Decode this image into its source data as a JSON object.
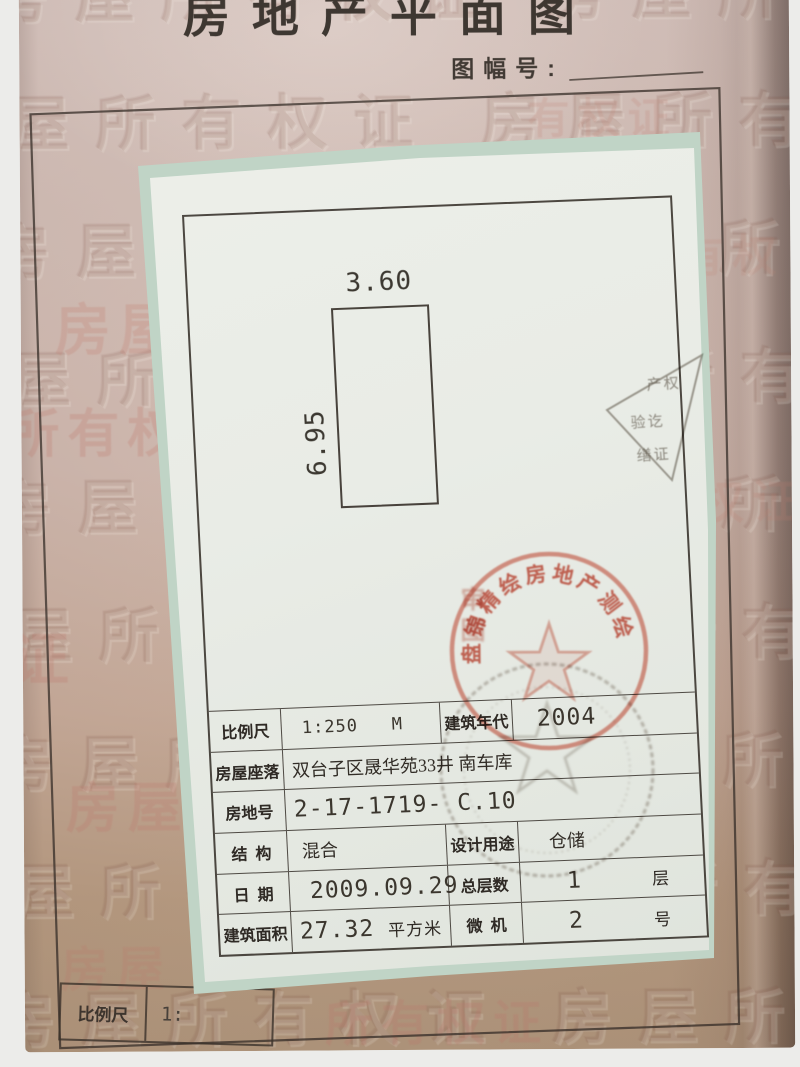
{
  "photo": {
    "title": "房地产平面图",
    "sheet_label": "图幅号:",
    "watermark_text": "房屋所有权证",
    "watermark_accents": [
      {
        "t": "房屋",
        "x": 34,
        "y": 292,
        "s": 56,
        "o": 0.28
      },
      {
        "t": "所有权",
        "x": -14,
        "y": 398,
        "s": 52,
        "o": 0.3
      },
      {
        "t": "证",
        "x": -12,
        "y": 618,
        "s": 58,
        "o": 0.3
      },
      {
        "t": "房屋",
        "x": 42,
        "y": 770,
        "s": 54,
        "o": 0.3
      },
      {
        "t": "有权证",
        "x": 508,
        "y": 94,
        "s": 42,
        "o": 0.2
      },
      {
        "t": "有权",
        "x": 660,
        "y": 230,
        "s": 44,
        "o": 0.18
      },
      {
        "t": "权证",
        "x": 676,
        "y": 476,
        "s": 46,
        "o": 0.2
      },
      {
        "t": "房屋",
        "x": 36,
        "y": 936,
        "s": 48,
        "o": 0.26
      },
      {
        "t": "所有权证",
        "x": 300,
        "y": 992,
        "s": 48,
        "o": 0.3
      }
    ],
    "bottom_scale_label": "比例尺",
    "bottom_scale_value": "1:"
  },
  "floor_plan": {
    "top_dimension": "3.60",
    "side_dimension": "6.95"
  },
  "info_table": {
    "rows": [
      {
        "cells": [
          {
            "cls": "lab w0",
            "t": "比例尺"
          },
          {
            "cls": "val w1 p20 cad",
            "t": "1:250   M"
          },
          {
            "cls": "lab w2",
            "t": "建筑年代"
          },
          {
            "cls": "val w3 p24 cad big",
            "t": "2004"
          }
        ]
      },
      {
        "cells": [
          {
            "cls": "lab w0",
            "t": "房屋座落"
          },
          {
            "cls": "val wr p8 cn",
            "t": "双台子区晟华苑33井 南车库"
          }
        ]
      },
      {
        "cells": [
          {
            "cls": "lab w0",
            "t": "房地号"
          },
          {
            "cls": "val wr p8 cad big",
            "t": "2-17-1719- C.10"
          }
        ]
      },
      {
        "cells": [
          {
            "cls": "lab w0",
            "t": "结  构"
          },
          {
            "cls": "val w1 p14 cn",
            "t": "混合"
          },
          {
            "cls": "lab w2",
            "t": "设计用途"
          },
          {
            "cls": "val w3 p30 cn",
            "t": "仓储"
          }
        ]
      },
      {
        "cells": [
          {
            "cls": "lab w0",
            "t": "日  期"
          },
          {
            "cls": "val w1 p20 cad big",
            "t": "2009.09.29"
          },
          {
            "cls": "lab w2",
            "t": "总层数"
          },
          {
            "cls": "val w3 p46 cad big",
            "t": "1",
            "u": "层",
            "uc": "far"
          }
        ]
      },
      {
        "cells": [
          {
            "cls": "lab w0",
            "t": "建筑面积"
          },
          {
            "cls": "val w1 p8 cad big",
            "t": "27.32",
            "u": "平方米",
            "uc": "near"
          },
          {
            "cls": "lab w2",
            "t": "微  机"
          },
          {
            "cls": "val w3 p46 cad big",
            "t": "2",
            "u": "号",
            "uc": "far"
          }
        ]
      }
    ]
  },
  "stamps": {
    "red_round": {
      "arc_text": "盘锦精绘房地产测绘",
      "side_text": "审图",
      "color": "#c94a36"
    },
    "gray_round": {
      "color": "#8b8075"
    },
    "triangle": {
      "lines": [
        "产权",
        "验讫",
        "缮证"
      ],
      "color": "#6e6459"
    }
  },
  "colors": {
    "page": "#cfb7ad",
    "paper": "#eaede7",
    "tape": "#c0d4c6",
    "line": "#3c3630",
    "red_stamp": "#c94a36",
    "gray_stamp": "#8b8075"
  }
}
